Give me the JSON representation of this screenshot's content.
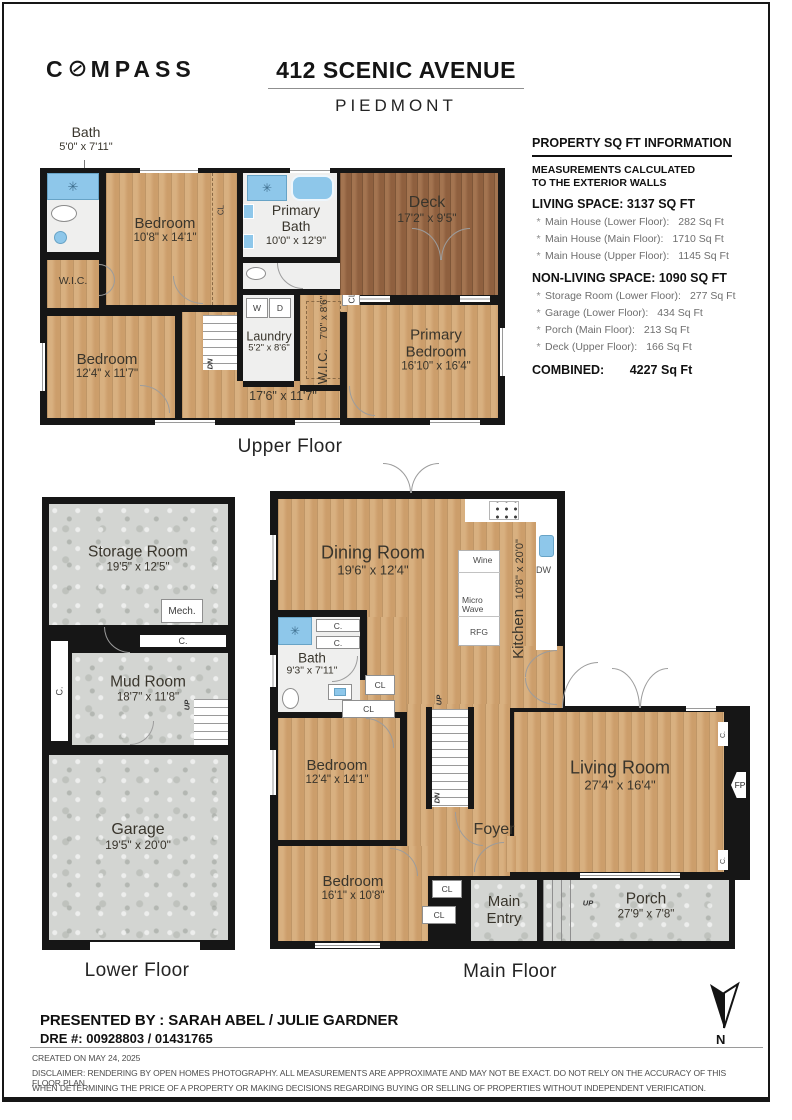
{
  "header": {
    "brand": "COMPASS",
    "address": "412 SCENIC AVENUE",
    "city": "PIEDMONT"
  },
  "info_panel": {
    "title": "PROPERTY SQ FT INFORMATION",
    "subtitle_line1": "MEASUREMENTS CALCULATED",
    "subtitle_line2": "TO THE EXTERIOR WALLS",
    "living_header": "LIVING SPACE: 3137 SQ FT",
    "living_items": [
      {
        "label": "Main House (Lower Floor):",
        "value": "282 Sq Ft"
      },
      {
        "label": "Main House (Main Floor):",
        "value": "1710 Sq Ft"
      },
      {
        "label": "Main House (Upper Floor):",
        "value": "1145 Sq Ft"
      }
    ],
    "nonliving_header": "NON-LIVING SPACE: 1090 SQ FT",
    "nonliving_items": [
      {
        "label": "Storage Room (Lower Floor):",
        "value": "277 Sq Ft"
      },
      {
        "label": "Garage (Lower Floor):",
        "value": "434 Sq Ft"
      },
      {
        "label": "Porch (Main Floor):",
        "value": "213 Sq Ft"
      },
      {
        "label": "Deck (Upper Floor):",
        "value": "166 Sq Ft"
      }
    ],
    "combined_label": "COMBINED:",
    "combined_value": "4227 Sq Ft",
    "bullet": "*"
  },
  "floors": {
    "upper": {
      "title": "Upper Floor",
      "bath_ext": {
        "name": "Bath",
        "dims": "5'0\" x 7'11\""
      },
      "bedroom_top": {
        "name": "Bedroom",
        "dims": "10'8\" x 14'1\""
      },
      "bedroom_left": {
        "name": "Bedroom",
        "dims": "12'4\" x 11'7\""
      },
      "wic_left": "W.I.C.",
      "closet_top": "CL",
      "primary_bath": {
        "name": "Primary Bath",
        "dims": "10'0\" x 12'9\""
      },
      "laundry": {
        "name": "Laundry",
        "dims": "5'2\" x 8'6\""
      },
      "washer": "W",
      "dryer": "D",
      "wic_center": {
        "name": "W.I.C.",
        "dims": "7'0\" x 8'6\""
      },
      "closet_right": "CL",
      "deck": {
        "name": "Deck",
        "dims": "17'2\" x 9'5\""
      },
      "primary_bedroom": {
        "name": "Primary Bedroom",
        "dims": "16'10\" x 16'4\""
      },
      "hall_dims": "17'6\" x 11'7\"",
      "stairs_down": "DN"
    },
    "main": {
      "title": "Main Floor",
      "dining": {
        "name": "Dining Room",
        "dims": "19'6\" x 12'4\""
      },
      "kitchen": {
        "name": "Kitchen",
        "dims": "10'8\" x 20'0\""
      },
      "island_wine": "Wine",
      "island_micro": "Micro Wave",
      "island_rfg": "RFG",
      "dishwasher": "DW",
      "bath": {
        "name": "Bath",
        "dims": "9'3\" x 7'11\""
      },
      "closet_c1": "C.",
      "closet_c2": "C.",
      "closet_cl1": "CL",
      "closet_cl2": "CL",
      "bedroom_mid": {
        "name": "Bedroom",
        "dims": "12'4\" x 14'1\""
      },
      "bedroom_bottom": {
        "name": "Bedroom",
        "dims": "16'1\" x 10'8\""
      },
      "living": {
        "name": "Living Room",
        "dims": "27'4\" x 16'4\""
      },
      "fireplace": "FP",
      "closet_right_top": "C.",
      "closet_right_bottom": "C.",
      "foyer": "Foyer",
      "main_entry": "Main Entry",
      "porch": {
        "name": "Porch",
        "dims": "27'9\" x 7'8\""
      },
      "closet_entry1": "CL",
      "closet_entry2": "CL",
      "stairs_up": "UP",
      "stairs_down": "DN",
      "porch_up": "UP"
    },
    "lower": {
      "title": "Lower Floor",
      "storage": {
        "name": "Storage Room",
        "dims": "19'5\" x 12'5\""
      },
      "mech": "Mech.",
      "closet_top": "C.",
      "closet_left": "C.",
      "mudroom": {
        "name": "Mud Room",
        "dims": "18'7\" x 11'8\""
      },
      "stairs_up": "UP",
      "garage": {
        "name": "Garage",
        "dims": "19'5\" x 20'0\""
      }
    }
  },
  "footer": {
    "presented_by": "PRESENTED BY :  SARAH ABEL / JULIE GARDNER",
    "dre": "DRE #: 00928803 / 01431765",
    "created": "CREATED ON MAY 24, 2025",
    "disclaimer_line1": "DISCLAIMER: RENDERING BY OPEN HOMES PHOTOGRAPHY. ALL MEASUREMENTS ARE APPROXIMATE AND MAY NOT BE EXACT. DO NOT RELY ON THE ACCURACY OF THIS FLOOR PLAN",
    "disclaimer_line2": "WHEN DETERMINING THE PRICE OF A PROPERTY OR MAKING DECISIONS REGARDING BUYING OR SELLING OF PROPERTIES WITHOUT INDEPENDENT VERIFICATION.",
    "north_label": "N"
  },
  "icons": {
    "shower_sparkle": "✳"
  },
  "colors": {
    "wood_light": "#d2a572",
    "wood_dark": "#9b6a47",
    "concrete": "#d3d5d2",
    "fixture_blue": "#8ec7ea",
    "wall": "#161616"
  }
}
